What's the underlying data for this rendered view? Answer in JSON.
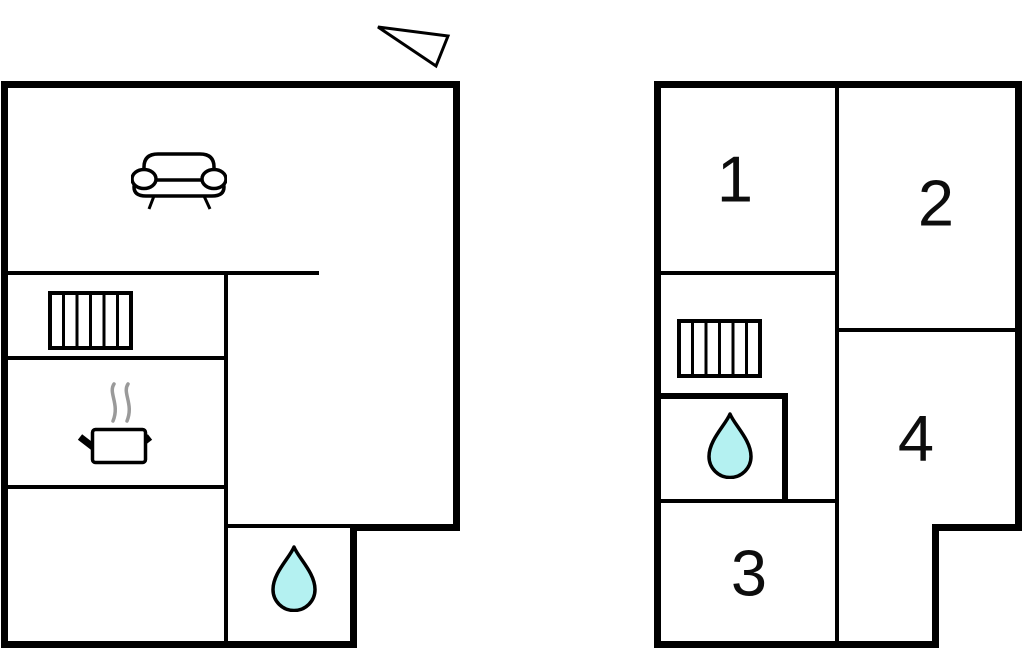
{
  "background": "#ffffff",
  "colors": {
    "wall": "#000000",
    "label": "#0d0d0d",
    "water_fill": "#b4f1f1",
    "steam": "#9a9a9a"
  },
  "compass": {
    "icon": "north-arrow-icon"
  },
  "floors": [
    {
      "name": "ground-floor",
      "room_labels": [],
      "icons": [
        "sofa-icon",
        "radiator-icon",
        "stove-pot-icon",
        "water-drop-icon"
      ]
    },
    {
      "name": "upper-floor",
      "room_labels": [
        "1",
        "2",
        "3",
        "4"
      ],
      "icons": [
        "radiator-icon",
        "water-drop-icon"
      ]
    }
  ]
}
